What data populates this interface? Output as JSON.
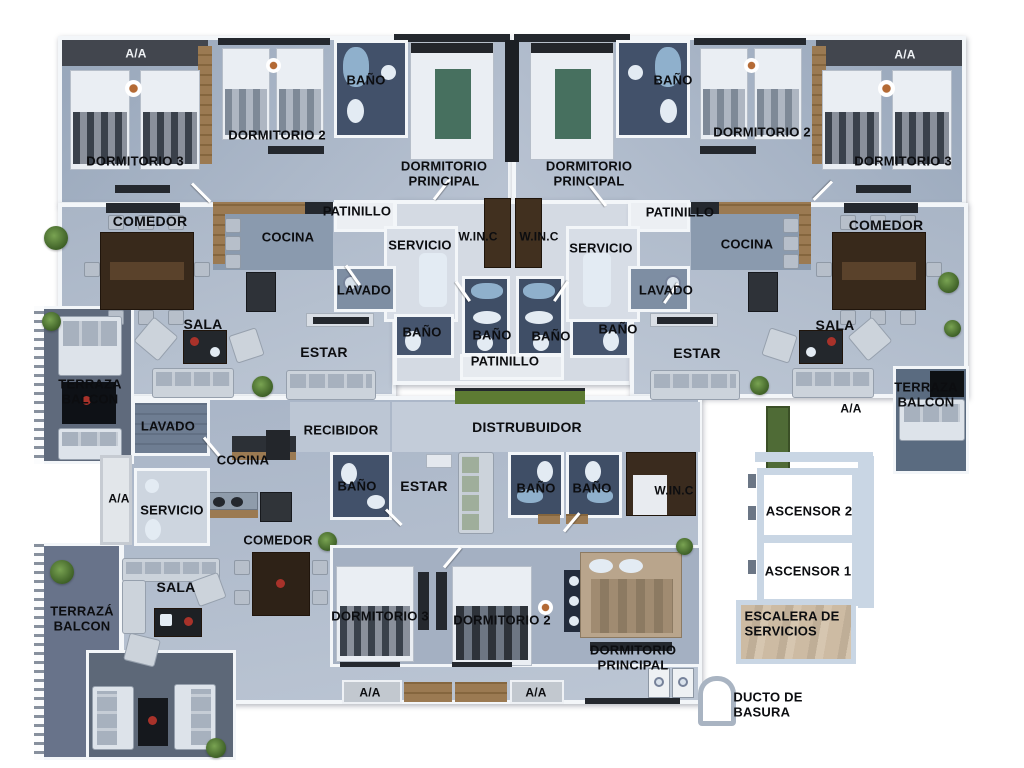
{
  "figure": {
    "kind": "apartment-floor-plan"
  },
  "palette": {
    "floor_light": "#b2bdcd",
    "floor_pale": "#d4dae3",
    "wall_white": "#f3f6f9",
    "bath_dark": "#42516a",
    "wood": "#9b7a52",
    "closet_brown": "#41301f",
    "terrace_dark": "#5f6a7c",
    "grass_green": "#5d7b33",
    "ac_strip_dark": "#42464e",
    "elevator_wall_blue": "#c9d6e4",
    "accent_red": "#a8322a",
    "accent_teal": "#47705f"
  },
  "labels": [
    {
      "name": "aa-top-left",
      "text": "A/A",
      "x": 136,
      "y": 54,
      "size": 12,
      "color": "#eef1f4"
    },
    {
      "name": "dormitorio3-top-left",
      "text": "DORMITORIO 3",
      "x": 135,
      "y": 162,
      "size": 13
    },
    {
      "name": "dormitorio2-top-left",
      "text": "DORMITORIO 2",
      "x": 277,
      "y": 136,
      "size": 13
    },
    {
      "name": "bano-top-left",
      "text": "BAÑO",
      "x": 366,
      "y": 81,
      "size": 13
    },
    {
      "name": "dormitorio-principal-top-left",
      "text": "DORMITORIO\nPRINCIPAL",
      "x": 444,
      "y": 174,
      "size": 13
    },
    {
      "name": "dormitorio-principal-top-right",
      "text": "DORMITORIO\nPRINCIPAL",
      "x": 589,
      "y": 174,
      "size": 13
    },
    {
      "name": "bano-top-right",
      "text": "BAÑO",
      "x": 673,
      "y": 81,
      "size": 13
    },
    {
      "name": "dormitorio2-top-right",
      "text": "DORMITORIO 2",
      "x": 762,
      "y": 133,
      "size": 13
    },
    {
      "name": "dormitorio3-top-right",
      "text": "DORMITORIO 3",
      "x": 903,
      "y": 162,
      "size": 13
    },
    {
      "name": "aa-top-right",
      "text": "A/A",
      "x": 905,
      "y": 55,
      "size": 12,
      "color": "#eef1f4"
    },
    {
      "name": "comedor-left",
      "text": "COMEDOR",
      "x": 150,
      "y": 222,
      "size": 14
    },
    {
      "name": "cocina-left",
      "text": "COCINA",
      "x": 288,
      "y": 238,
      "size": 13
    },
    {
      "name": "patinillo-top-left",
      "text": "PATINILLO",
      "x": 357,
      "y": 212,
      "size": 13
    },
    {
      "name": "servicio-left",
      "text": "SERVICIO",
      "x": 420,
      "y": 246,
      "size": 13
    },
    {
      "name": "winc-top-left",
      "text": "W.IN.C",
      "x": 478,
      "y": 237,
      "size": 12
    },
    {
      "name": "winc-top-right",
      "text": "W.IN.C",
      "x": 539,
      "y": 237,
      "size": 12
    },
    {
      "name": "servicio-right",
      "text": "SERVICIO",
      "x": 601,
      "y": 249,
      "size": 13
    },
    {
      "name": "patinillo-top-right",
      "text": "PATINILLO",
      "x": 680,
      "y": 213,
      "size": 13
    },
    {
      "name": "lavado-left",
      "text": "LAVADO",
      "x": 364,
      "y": 291,
      "size": 13
    },
    {
      "name": "lavado-right",
      "text": "LAVADO",
      "x": 666,
      "y": 291,
      "size": 13
    },
    {
      "name": "bano-mid-left",
      "text": "BAÑO",
      "x": 422,
      "y": 333,
      "size": 13
    },
    {
      "name": "bano-center-left",
      "text": "BAÑO",
      "x": 492,
      "y": 336,
      "size": 13
    },
    {
      "name": "bano-center-right",
      "text": "BAÑO",
      "x": 551,
      "y": 337,
      "size": 13
    },
    {
      "name": "bano-mid-right",
      "text": "BAÑO",
      "x": 618,
      "y": 330,
      "size": 13
    },
    {
      "name": "patinillo-bottom-center",
      "text": "PATINILLO",
      "x": 505,
      "y": 362,
      "size": 13
    },
    {
      "name": "sala-left",
      "text": "SALA",
      "x": 203,
      "y": 325,
      "size": 14
    },
    {
      "name": "estar-left",
      "text": "ESTAR",
      "x": 324,
      "y": 353,
      "size": 14
    },
    {
      "name": "cocina-right",
      "text": "COCINA",
      "x": 747,
      "y": 245,
      "size": 13
    },
    {
      "name": "comedor-right",
      "text": "COMEDOR",
      "x": 886,
      "y": 226,
      "size": 14
    },
    {
      "name": "sala-right",
      "text": "SALA",
      "x": 835,
      "y": 326,
      "size": 14
    },
    {
      "name": "estar-right",
      "text": "ESTAR",
      "x": 697,
      "y": 354,
      "size": 14
    },
    {
      "name": "terraza-balcon-left",
      "text": "TERRAZA\nBALCON",
      "x": 90,
      "y": 392,
      "size": 13
    },
    {
      "name": "terraza-balcon-right",
      "text": "TERRAZA\nBALCON",
      "x": 926,
      "y": 395,
      "size": 13
    },
    {
      "name": "aa-mid-right",
      "text": "A/A",
      "x": 851,
      "y": 409,
      "size": 12
    },
    {
      "name": "distribuidor",
      "text": "DISTRUBUIDOR",
      "x": 527,
      "y": 428,
      "size": 14
    },
    {
      "name": "recibidor",
      "text": "RECIBIDOR",
      "x": 341,
      "y": 431,
      "size": 13
    },
    {
      "name": "lavado-apt3",
      "text": "LAVADO",
      "x": 168,
      "y": 427,
      "size": 13
    },
    {
      "name": "cocina-apt3",
      "text": "COCINA",
      "x": 243,
      "y": 461,
      "size": 13
    },
    {
      "name": "aa-apt3-left",
      "text": "A/A",
      "x": 119,
      "y": 499,
      "size": 12
    },
    {
      "name": "servicio-apt3",
      "text": "SERVICIO",
      "x": 172,
      "y": 511,
      "size": 13
    },
    {
      "name": "comedor-apt3",
      "text": "COMEDOR",
      "x": 278,
      "y": 541,
      "size": 13
    },
    {
      "name": "bano-apt3-left",
      "text": "BAÑO",
      "x": 357,
      "y": 487,
      "size": 13
    },
    {
      "name": "estar-apt3",
      "text": "ESTAR",
      "x": 424,
      "y": 487,
      "size": 14
    },
    {
      "name": "bano-apt3-mid1",
      "text": "BAÑO",
      "x": 536,
      "y": 489,
      "size": 13
    },
    {
      "name": "bano-apt3-mid2",
      "text": "BAÑO",
      "x": 592,
      "y": 489,
      "size": 13
    },
    {
      "name": "winc-apt3",
      "text": "W.IN.C",
      "x": 674,
      "y": 491,
      "size": 12
    },
    {
      "name": "sala-apt3",
      "text": "SALA",
      "x": 176,
      "y": 588,
      "size": 14
    },
    {
      "name": "terraza-balcon-bottom",
      "text": "TERRAZÁ\nBALCON",
      "x": 82,
      "y": 619,
      "size": 13
    },
    {
      "name": "dormitorio3-apt3",
      "text": "DORMITORIO 3",
      "x": 380,
      "y": 617,
      "size": 13
    },
    {
      "name": "dormitorio2-apt3",
      "text": "DORMITORIO 2",
      "x": 502,
      "y": 621,
      "size": 13
    },
    {
      "name": "dormitorio-principal-apt3",
      "text": "DORMITORIO\nPRINCIPAL",
      "x": 633,
      "y": 658,
      "size": 13
    },
    {
      "name": "aa-apt3-bottom1",
      "text": "A/A",
      "x": 370,
      "y": 693,
      "size": 12
    },
    {
      "name": "aa-apt3-bottom2",
      "text": "A/A",
      "x": 536,
      "y": 693,
      "size": 12
    },
    {
      "name": "ascensor2",
      "text": "ASCENSOR 2",
      "x": 809,
      "y": 512,
      "size": 13
    },
    {
      "name": "ascensor1",
      "text": "ASCENSOR 1",
      "x": 808,
      "y": 572,
      "size": 13
    },
    {
      "name": "escalera-servicios",
      "text": "ESCALERA DE\nSERVICIOS",
      "x": 792,
      "y": 624,
      "size": 13,
      "align": "left"
    },
    {
      "name": "ducto-basura",
      "text": "DUCTO DE\nBASURA",
      "x": 768,
      "y": 705,
      "size": 13,
      "align": "left"
    }
  ]
}
